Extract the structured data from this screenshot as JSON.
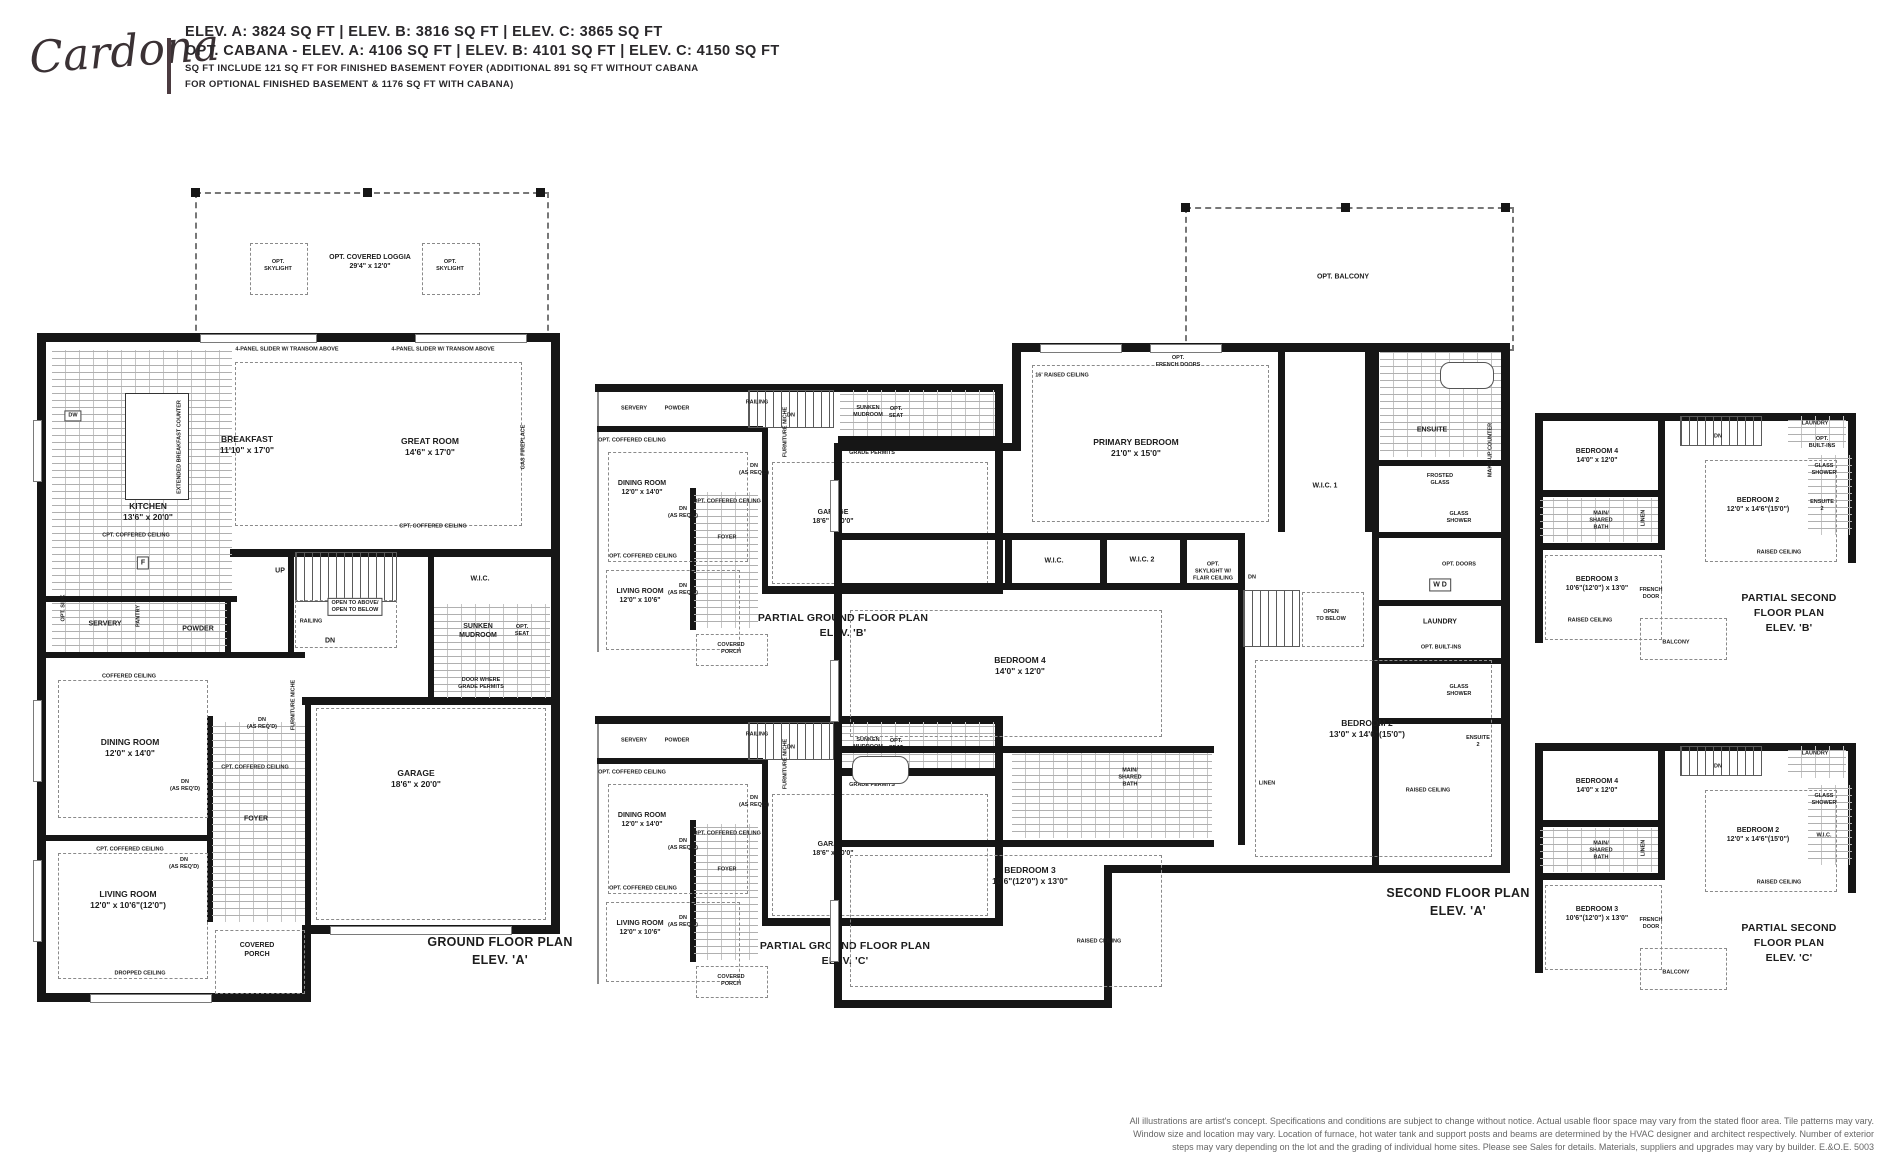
{
  "header": {
    "model_name": "Cardona",
    "elevations_line": "ELEV. A: 3824 SQ FT  |  ELEV. B: 3816 SQ FT  |  ELEV. C: 3865 SQ FT",
    "cabana_line": "OPT. CABANA - ELEV. A: 4106 SQ FT  |  ELEV. B: 4101 SQ FT  |  ELEV. C: 4150 SQ FT",
    "note_line1": "SQ FT INCLUDE 121 SQ FT FOR FINISHED BASEMENT FOYER (ADDITIONAL 891 SQ FT WITHOUT CABANA",
    "note_line2": "FOR OPTIONAL FINISHED BASEMENT & 1176 SQ FT WITH CABANA)"
  },
  "ground_floor_a": {
    "caption": "GROUND FLOOR PLAN\nELEV. 'A'",
    "labels": {
      "loggia": "OPT. COVERED LOGGIA\n29'4\" x 12'0\"",
      "skylight_left": "OPT.\nSKYLIGHT",
      "skylight_right": "OPT.\nSKYLIGHT",
      "slider_left": "4-PANEL SLIDER W/ TRANSOM ABOVE",
      "slider_right": "4-PANEL SLIDER W/ TRANSOM ABOVE",
      "breakfast": "BREAKFAST\n11'10\" x 17'0\"",
      "great_room": "GREAT ROOM\n14'6\" x 17'0\"",
      "kitchen": "KITCHEN\n13'6\" x 20'0\"",
      "extended_counter": "EXTENDED BREAKFAST COUNTER",
      "kitchen_ceiling": "CPT. COFFERED CEILING",
      "great_ceiling": "CPT. COFFERED CEILING",
      "dw": "DW",
      "fridge": "F",
      "gas_fireplace": "GAS FIREPLACE",
      "servery": "SERVERY",
      "pantry": "PANTRY",
      "powder": "POWDER",
      "opt_sink": "OPT. SINK",
      "up": "UP",
      "dn": "DN",
      "open_above": "OPEN TO ABOVE/\nOPEN TO BELOW",
      "railing": "RAILING",
      "wic": "W.I.C.",
      "mudroom": "SUNKEN\nMUDROOM",
      "opt_seat": "OPT.\nSEAT",
      "door_grade": "DOOR WHERE\nGRADE PERMITS",
      "coffered": "COFFERED CEILING",
      "dining": "DINING ROOM\n12'0\" x 14'0\"",
      "dn_req_1": "DN\n(AS REQ'D)",
      "dn_req_2": "DN\n(AS REQ'D)",
      "dn_req_3": "DN\n(AS REQ'D)",
      "foyer": "FOYER",
      "foyer_ceiling": "CPT. COFFERED CEILING",
      "furniture_niche": "FURNITURE NICHE",
      "garage": "GARAGE\n18'6\" x 20'0\"",
      "living_ceiling": "CPT. COFFERED CEILING",
      "living": "LIVING ROOM\n12'0\" x 10'6\"(12'0\")",
      "dropped_ceiling": "DROPPED CEILING",
      "porch": "COVERED\nPORCH"
    }
  },
  "partial_ground_b": {
    "caption": "PARTIAL GROUND FLOOR PLAN\nELEV. 'B'",
    "labels": {
      "servery": "SERVERY",
      "powder": "POWDER",
      "dining_ceiling": "OPT. COFFERED CEILING",
      "dining": "DINING ROOM\n12'0\" x 14'0\"",
      "dn_req_1": "DN\n(AS REQ'D)",
      "furniture_niche": "FURNITURE NICHE",
      "railing": "RAILING",
      "dn": "DN",
      "mudroom": "SUNKEN\nMUDROOM",
      "opt_seat": "OPT.\nSEAT",
      "door_grade": "DOOR WHERE\nGRADE PERMITS",
      "garage": "GARAGE\n18'6\" x 20'0\"",
      "foyer_ceiling": "OPT. COFFERED CEILING",
      "foyer": "FOYER",
      "dn_req_2": "DN\n(AS REQ'D)",
      "dn_req_3": "DN\n(AS REQ'D)",
      "living_ceiling": "OPT. COFFERED CEILING",
      "living": "LIVING ROOM\n12'0\" x 10'6\"",
      "porch": "COVERED\nPORCH"
    }
  },
  "partial_ground_c": {
    "caption": "PARTIAL GROUND FLOOR PLAN\nELEV. 'C'",
    "labels": {
      "servery": "SERVERY",
      "powder": "POWDER",
      "dining_ceiling": "OPT. COFFERED CEILING",
      "dining": "DINING ROOM\n12'0\" x 14'0\"",
      "dn_req_1": "DN\n(AS REQ'D)",
      "furniture_niche": "FURNITURE NICHE",
      "railing": "RAILING",
      "dn": "DN",
      "mudroom": "SUNKEN\nMUDROOM",
      "opt_seat": "OPT.\nSEAT",
      "door_grade": "DOOR WHERE\nGRADE PERMITS",
      "garage": "GARAGE\n18'6\" x 20'0\"",
      "foyer_ceiling": "OPT. COFFERED CEILING",
      "foyer": "FOYER",
      "dn_req_2": "DN\n(AS REQ'D)",
      "dn_req_3": "DN\n(AS REQ'D)",
      "living_ceiling": "OPT. COFFERED CEILING",
      "living": "LIVING ROOM\n12'0\" x 10'6\"",
      "porch": "COVERED\nPORCH"
    }
  },
  "second_floor_a": {
    "caption": "SECOND FLOOR PLAN\nELEV. 'A'",
    "labels": {
      "balcony": "OPT. BALCONY",
      "french_doors": "OPT.\nFRENCH DOORS",
      "raised_16": "16' RAISED CEILING",
      "primary": "PRIMARY BEDROOM\n21'0\" x 15'0\"",
      "ensuite": "ENSUITE",
      "frosted_glass": "FROSTED\nGLASS",
      "makeup_counter": "MAKE-UP COUNTER",
      "glass_shower_1": "GLASS\nSHOWER",
      "wic1": "W.I.C. 1",
      "wic": "W.I.C.",
      "wic2": "W.I.C. 2",
      "opt_skylight": "OPT.\nSKYLIGHT W/\nFLAIR CEILING",
      "open_below": "OPEN\nTO BELOW",
      "wd": "W   D",
      "opt_doors": "OPT. DOORS",
      "laundry": "LAUNDRY",
      "builtins": "OPT. BUILT-INS",
      "bedroom4": "BEDROOM 4\n14'0\" x 12'0\"",
      "glass_shower_2": "GLASS\nSHOWER",
      "ensuite2": "ENSUITE\n2",
      "bedroom2": "BEDROOM 2\n13'0\" x 14'6\"(15'0\")",
      "shared_bath": "MAIN/\nSHARED\nBATH",
      "linen": "LINEN",
      "raised_ceiling_1": "RAISED CEILING",
      "bedroom3": "BEDROOM 3\n10'6\"(12'0\") x 13'0\"",
      "raised_ceiling_2": "RAISED CEILING",
      "dn": "DN"
    }
  },
  "partial_second_b": {
    "caption": "PARTIAL SECOND FLOOR PLAN\nELEV. 'B'",
    "labels": {
      "bedroom4": "BEDROOM 4\n14'0\" x 12'0\"",
      "laundry": "LAUNDRY",
      "builtins": "OPT.\nBUILT-INS",
      "glass_shower": "GLASS\nSHOWER",
      "bedroom2": "BEDROOM 2\n12'0\" x 14'6\"(15'0\")",
      "ensuite2": "ENSUITE\n2",
      "shared_bath": "MAIN/\nSHARED\nBATH",
      "linen": "LINEN",
      "raised_ceiling_1": "RAISED CEILING",
      "bedroom3": "BEDROOM 3\n10'6\"(12'0\") x 13'0\"",
      "french_door": "FRENCH\nDOOR",
      "raised_ceiling_2": "RAISED CEILING",
      "balcony": "BALCONY",
      "dn": "DN"
    }
  },
  "partial_second_c": {
    "caption": "PARTIAL SECOND FLOOR PLAN\nELEV. 'C'",
    "labels": {
      "bedroom4": "BEDROOM 4\n14'0\" x 12'0\"",
      "laundry": "LAUNDRY",
      "glass_shower": "GLASS\nSHOWER",
      "bedroom2": "BEDROOM 2\n12'0\" x 14'6\"(15'0\")",
      "wic": "W.I.C.",
      "shared_bath": "MAIN/\nSHARED\nBATH",
      "linen": "LINEN",
      "raised_ceiling_1": "RAISED CEILING",
      "bedroom3": "BEDROOM 3\n10'6\"(12'0\") x 13'0\"",
      "french_door": "FRENCH\nDOOR",
      "balcony": "BALCONY",
      "dn": "DN"
    }
  },
  "disclaimer": {
    "line1": "All illustrations are artist's concept. Specifications and conditions are subject to change without notice. Actual usable floor space may vary from the stated floor area. Tile patterns may vary.",
    "line2": "Window size and location may vary. Location of furnace, hot water tank and support posts and beams are determined by the HVAC designer and architect respectively. Number of exterior",
    "line3": "steps may vary depending on the lot and the grading of individual home sites. Please see Sales for details. Materials, suppliers and upgrades may vary by builder. E.&O.E. 5003"
  }
}
